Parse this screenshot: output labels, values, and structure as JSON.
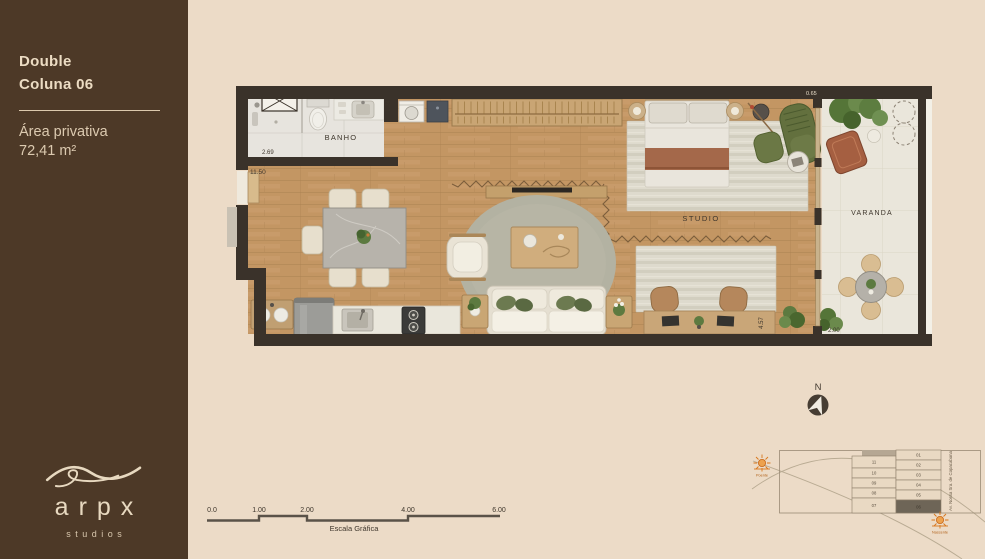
{
  "sidebar": {
    "title_line1": "Double",
    "title_line2": "Coluna 06",
    "area_label": "Área privativa",
    "area_value": "72,41 m²",
    "logo": {
      "name": "arpx",
      "sub": "studios"
    }
  },
  "plan": {
    "rooms": {
      "banho": "BANHO",
      "studio": "STUDIO",
      "varanda": "VARANDA"
    },
    "dims": {
      "banho_width": "2.69",
      "banho_depth": "1.24",
      "living_width": "11.50",
      "studio_gap": "0.65",
      "desk_depth": "4.57",
      "varanda_width": "2.00"
    }
  },
  "compass": {
    "north": "N"
  },
  "scalebar": {
    "ticks": [
      "0.0",
      "1.00",
      "2.00",
      "4.00",
      "6.00"
    ],
    "caption": "Escala Gráfica"
  },
  "siteplan": {
    "street": "Av. Nossa Sra. de Copacabana",
    "sun_west_label": "Poente",
    "sun_east_label": "Nascente",
    "left_units": [
      "11",
      "10",
      "09",
      "08",
      "07"
    ],
    "right_units": [
      "01",
      "02",
      "03",
      "04",
      "05",
      "06"
    ],
    "highlighted_unit": "06"
  },
  "colors": {
    "sidebar_brown": "#4d3927",
    "background_beige": "#ecdbc7",
    "wall_dark": "#3a322a",
    "wood_floor": "#c39663",
    "accent_green": "#63703e",
    "accent_terracotta": "#a55f41",
    "sun_orange": "#d9771c",
    "highlight_unit_fill": "#6e6557"
  }
}
